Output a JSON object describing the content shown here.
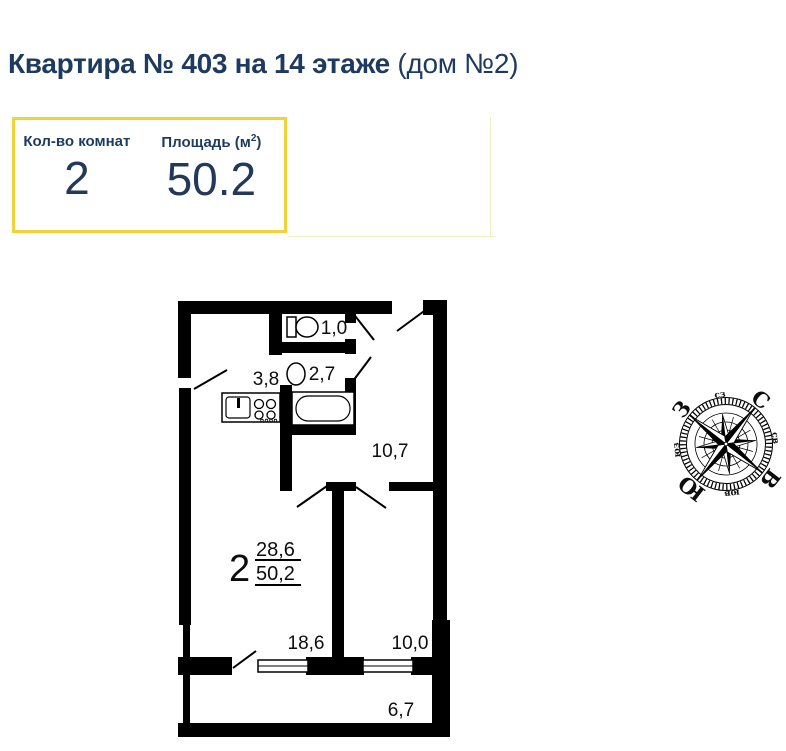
{
  "title": {
    "main": "Квартира № 403 на 14 этаже",
    "suffix": "(дом №2)"
  },
  "info_box": {
    "rooms_header": "Кол-во комнат",
    "area_header_pre": "Площадь (м",
    "area_header_sup": "2",
    "area_header_post": ")",
    "rooms_value": "2",
    "area_value": "50.2"
  },
  "floor_plan": {
    "room_areas": {
      "wc": "1,0",
      "bathroom": "2,7",
      "corridor": "3,8",
      "hall": "10,7",
      "living": "18,6",
      "bedroom": "10,0",
      "balcony": "6,7"
    },
    "summary": {
      "rooms": "2",
      "living_area": "28,6",
      "total_area": "50,2"
    }
  },
  "compass": {
    "cardinals": {
      "n": "С",
      "e": "В",
      "s": "Ю",
      "w": "З"
    },
    "intercardinals": {
      "ne": "св",
      "se": "юв",
      "sw": "юз",
      "nw": "сз"
    }
  },
  "colors": {
    "accent_yellow": "#f0d33a",
    "navy": "#1d3a5f",
    "plan_black": "#000000",
    "faint_rule": "#f2ecc2"
  }
}
